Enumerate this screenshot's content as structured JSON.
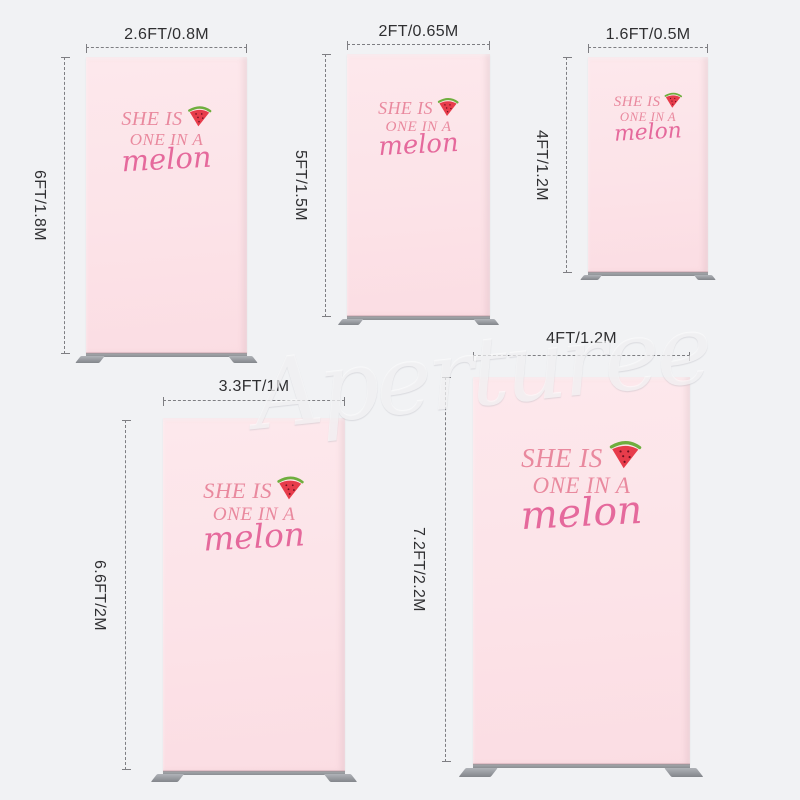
{
  "page": {
    "background_color": "#f1f2f4",
    "watermark_text": "Aperturee"
  },
  "backdrop_design": {
    "line1": "SHE IS",
    "line2": "ONE IN A",
    "line3": "melon",
    "icon": "watermelon-slice-icon",
    "panel_color": "#fce3e8",
    "serif_text_color": "#e9899e",
    "script_text_color": "#e5699c",
    "watermelon_red": "#e73c4b",
    "watermelon_green": "#6fae3e",
    "stand_gray": "#8b8e93"
  },
  "sizes": [
    {
      "width_label": "2.6FT/0.8M",
      "height_label": "6FT/1.8M"
    },
    {
      "width_label": "2FT/0.65M",
      "height_label": "5FT/1.5M"
    },
    {
      "width_label": "1.6FT/0.5M",
      "height_label": "4FT/1.2M"
    },
    {
      "width_label": "3.3FT/1M",
      "height_label": "6.6FT/2M"
    },
    {
      "width_label": "4FT/1.2M",
      "height_label": "7.2FT/2.2M"
    }
  ]
}
